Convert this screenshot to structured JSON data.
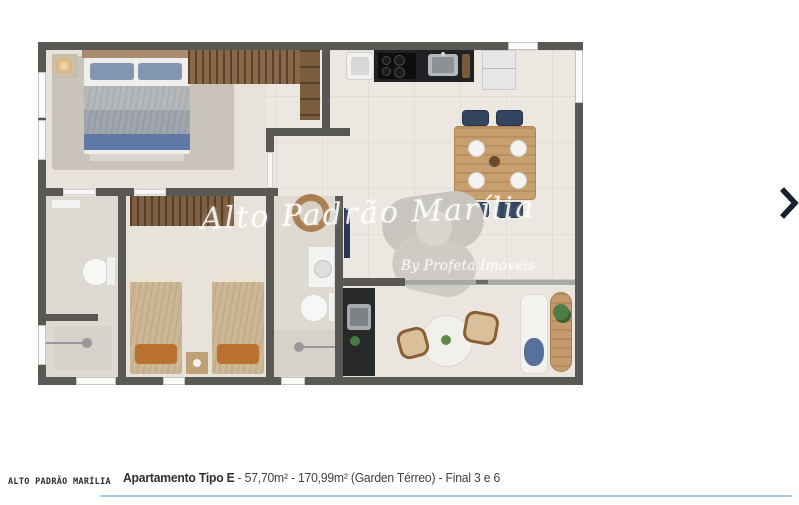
{
  "floorplan": {
    "watermark_line1": "Alto Padrão Marília",
    "watermark_line2": "By Profeta Imóveis"
  },
  "carousel": {
    "next_icon": "chevron-right"
  },
  "footer": {
    "brand": "ALTO PADRÃO MARÍLIA",
    "unit_name": "Apartamento Tipo E",
    "unit_details": " - 57,70m² - 170,99m² (Garden Térreo) - Final 3 e 6"
  },
  "colors": {
    "wall": "#5a5855",
    "floor": "#ece8e1",
    "accent_line": "#a6c9e4",
    "arrow": "#1a212e"
  }
}
